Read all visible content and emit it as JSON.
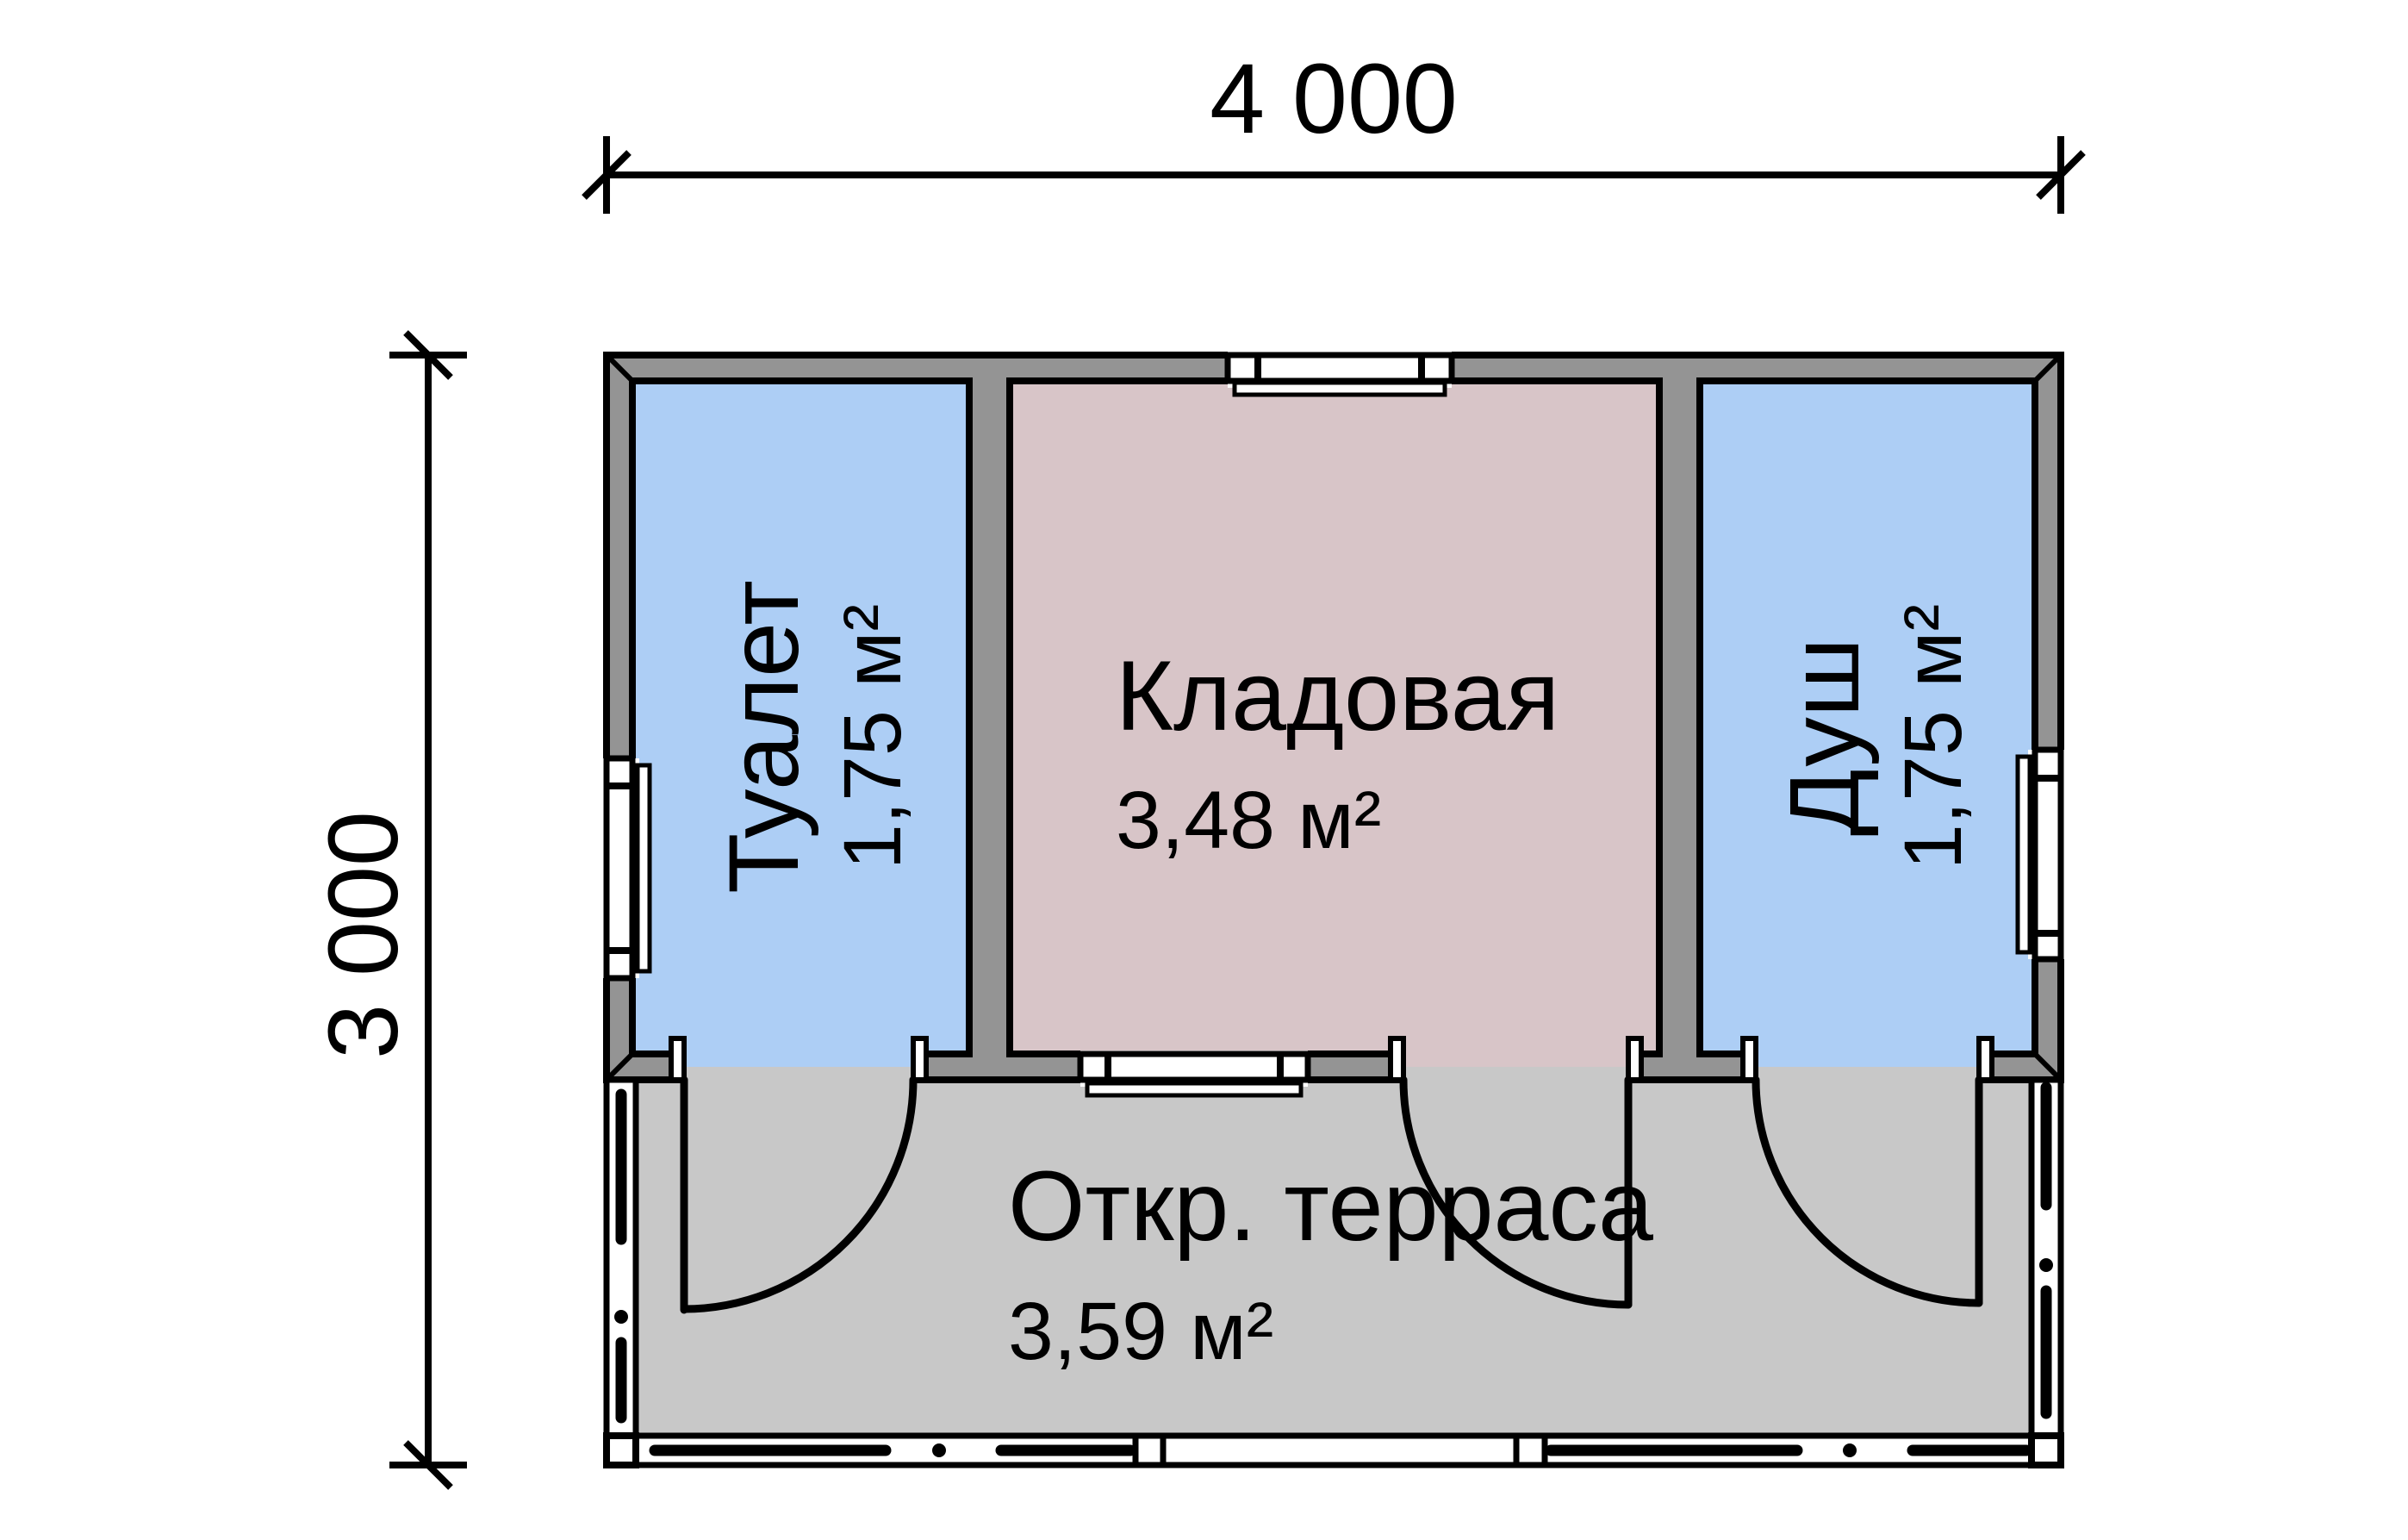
{
  "dimensions": {
    "width_label": "4 000",
    "height_label": "3 000"
  },
  "rooms": [
    {
      "id": "toilet",
      "name": "Туалет",
      "area": "1,75 м²"
    },
    {
      "id": "storage",
      "name": "Кладовая",
      "area": "3,48 м²"
    },
    {
      "id": "shower",
      "name": "Душ",
      "area": "1,75 м²"
    },
    {
      "id": "terrace",
      "name": "Откр. терраса",
      "area": "3,59 м²"
    }
  ],
  "colors": {
    "wall": "#949494",
    "terrace_floor": "#c8c8c8",
    "room_blue": "#adcef5",
    "room_pink": "#d8c5c8",
    "line": "#000000",
    "background": "#ffffff"
  }
}
